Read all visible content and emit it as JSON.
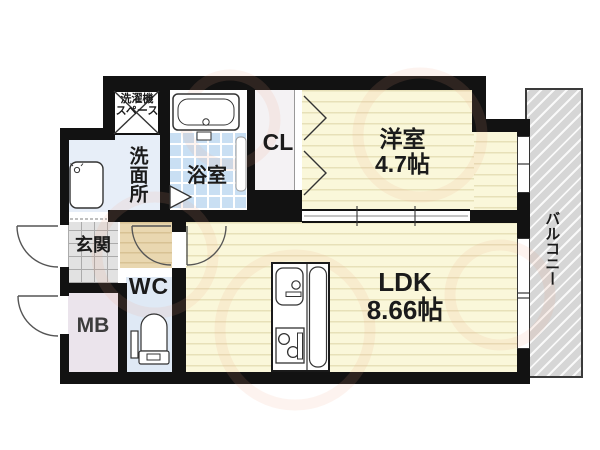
{
  "rooms": {
    "western_room": {
      "label": "洋室",
      "size": "4.7帖"
    },
    "ldk": {
      "label": "LDK",
      "size": "8.66帖"
    },
    "washroom": {
      "label": "洗面所"
    },
    "bathroom": {
      "label": "浴室"
    },
    "closet": {
      "label": "CL"
    },
    "entrance": {
      "label": "玄関"
    },
    "toilet": {
      "label": "WC"
    },
    "meter_box": {
      "label": "MB"
    },
    "balcony": {
      "label": "バルコニー"
    },
    "laundry_space": {
      "label_line1": "洗濯機",
      "label_line2": "スペース"
    }
  },
  "colors": {
    "wall": "#121212",
    "room_yellow": "#faf7da",
    "bathroom_tile": "#c9dff3",
    "washroom_blue": "#e7eef8",
    "wc_blue": "#dfe9f5",
    "meter_box_pink": "#ebe4ec",
    "entrance_gray": "#e2e2e2",
    "hallway_tan": "#e9d7b0",
    "balcony_gray": "#d6d6d6"
  }
}
